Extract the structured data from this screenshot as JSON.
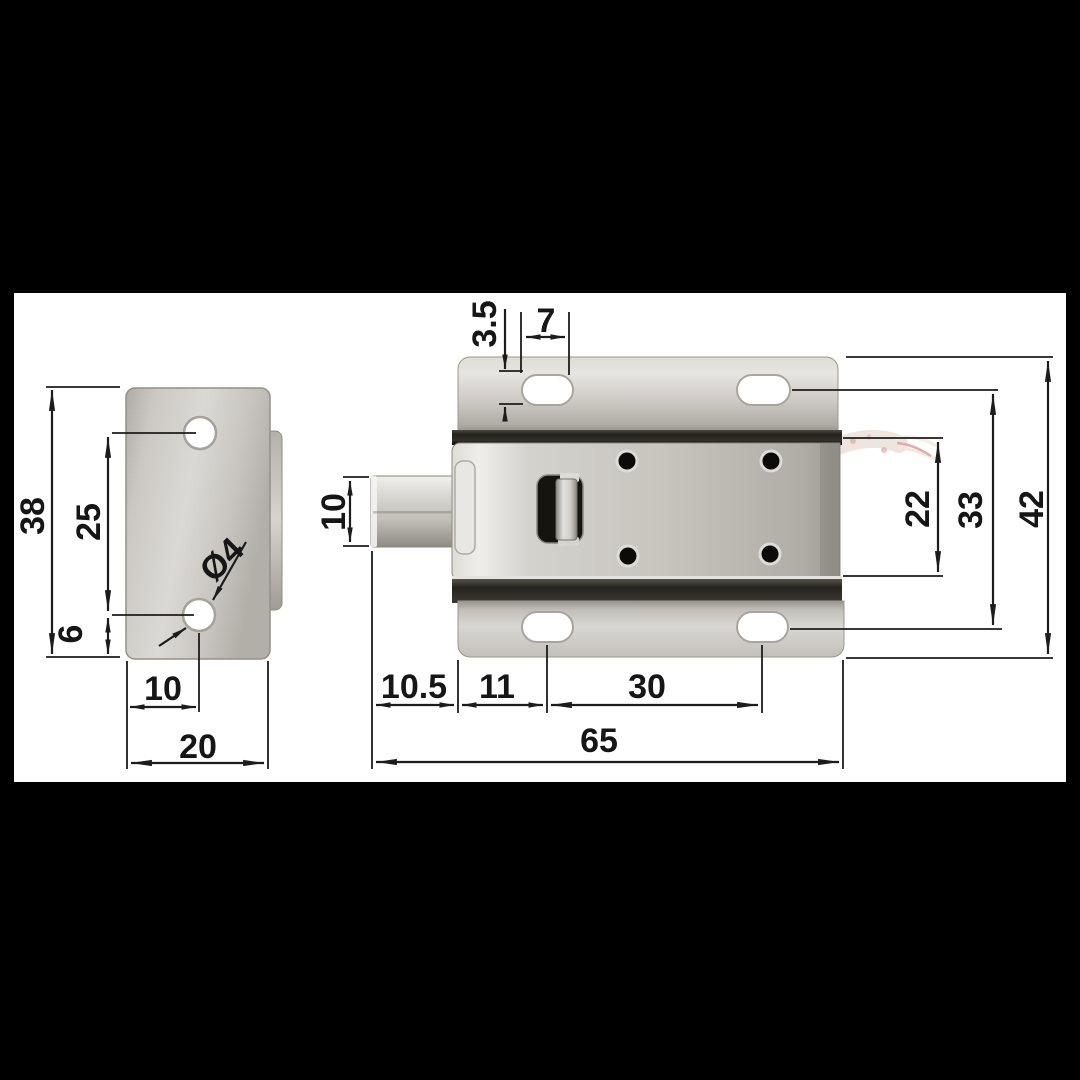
{
  "drawing": {
    "title": "cabinet-lock-dimension-drawing",
    "colors": {
      "background": "#ffffff",
      "frame": "#000000",
      "line": "#1c1c1c",
      "metal_light": "#e8e6e2",
      "metal_mid": "#c9c6c0",
      "metal_dark": "#8f8c85",
      "seam_dark": "#23211b",
      "wire_sleeve": "#f0e7e1",
      "wire_pink": "#e5aba6"
    },
    "views": {
      "strike_plate": {
        "label": "strike-plate-front-view"
      },
      "lock_body": {
        "label": "lock-body-front-view"
      }
    },
    "dims": {
      "plate_height": "38",
      "plate_hole_spacing": "25",
      "plate_hole_to_bottom": "6",
      "plate_hole_diameter": "Ø4",
      "plate_hole_offset": "10",
      "plate_width": "20",
      "slot_short_side": "3.5",
      "slot_long_side": "7",
      "latch_height": "10",
      "body_height": "22",
      "slot_rows_spacing": "33",
      "flange_height": "42",
      "latch_protrusion": "10.5",
      "edge_to_slot": "11",
      "slot_spacing": "30",
      "total_length": "65"
    }
  }
}
